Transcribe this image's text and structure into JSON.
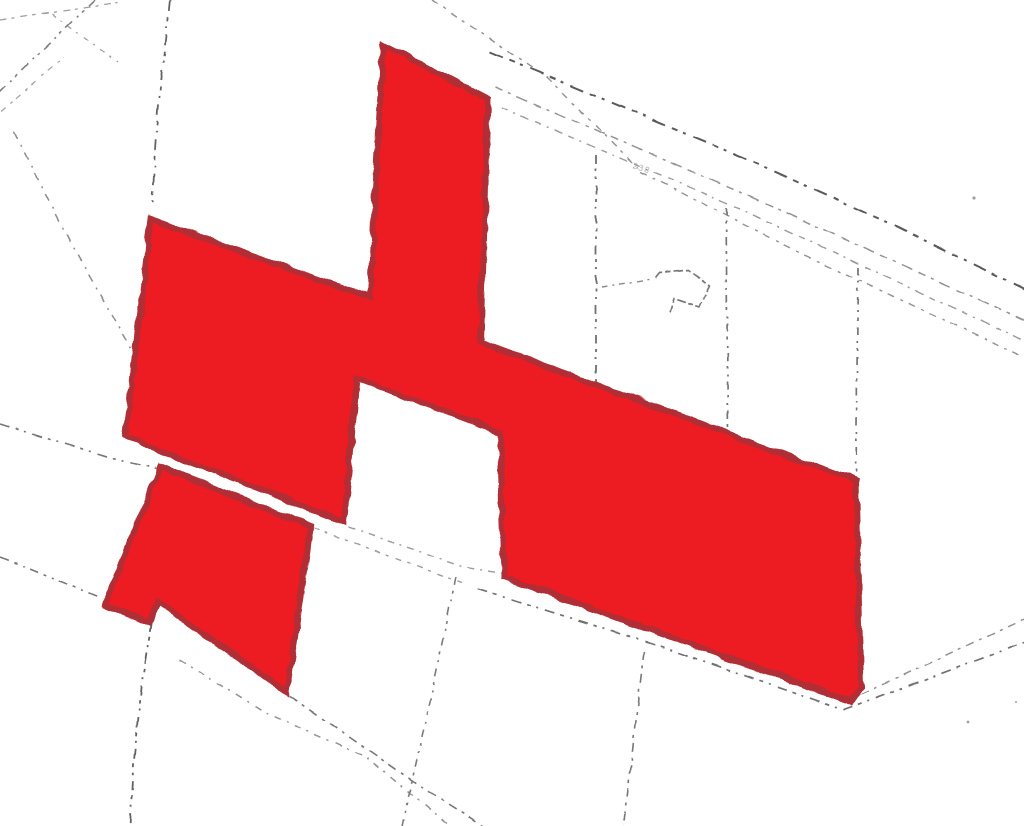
{
  "map": {
    "type": "cadastral-plan-scan",
    "background": "#ffffff",
    "highlight": {
      "fill": "#ec1c24",
      "stroke": "#b02e34",
      "stroke_width": 6
    },
    "label": {
      "text": "238",
      "size": 8,
      "color": "#979090",
      "opacity": 0.75,
      "transform": "translate(632 168) rotate(18)"
    },
    "specks": [
      {
        "x": 974,
        "y": 198,
        "r": 1.6
      },
      {
        "x": 968,
        "y": 722,
        "r": 1.4
      },
      {
        "x": 1016,
        "y": 702,
        "r": 1.0
      }
    ],
    "parcels": [
      {
        "name": "highlighted-parcel-main",
        "points": [
          [
            383,
            44
          ],
          [
            488,
            99
          ],
          [
            481,
            342
          ],
          [
            856,
            481
          ],
          [
            861,
            688
          ],
          [
            849,
            701
          ],
          [
            504,
            577
          ],
          [
            500,
            432
          ],
          [
            357,
            379
          ],
          [
            344,
            522
          ],
          [
            125,
            437
          ],
          [
            151,
            219
          ],
          [
            370,
            297
          ]
        ]
      },
      {
        "name": "highlighted-parcel-small",
        "points": [
          [
            160,
            467
          ],
          [
            311,
            526
          ],
          [
            287,
            692
          ],
          [
            158,
            602
          ],
          [
            150,
            622
          ],
          [
            105,
            604
          ]
        ]
      }
    ],
    "boundary_lines": [
      {
        "name": "tl-top-edge-line",
        "color": "#8d8d8d",
        "w": 1.3,
        "dash": "7 5 3 6",
        "points": [
          [
            0,
            20
          ],
          [
            118,
            3
          ]
        ]
      },
      {
        "name": "tl-cross-line-a",
        "color": "#909090",
        "w": 1.3,
        "dash": "5 6 2 7",
        "points": [
          [
            52,
            14
          ],
          [
            118,
            62
          ]
        ]
      },
      {
        "name": "tl-cross-line-b",
        "color": "#949494",
        "w": 1.3,
        "dash": "6 7 3 5",
        "points": [
          [
            0,
            112
          ],
          [
            64,
            57
          ]
        ]
      },
      {
        "name": "tl-diagonal-line",
        "color": "#6b6b6b",
        "w": 1.6,
        "dash": "9 6 3 5 2 6",
        "points": [
          [
            95,
            0
          ],
          [
            28,
            64
          ],
          [
            0,
            92
          ]
        ]
      },
      {
        "name": "tl-vertical-line",
        "color": "#4a4a4a",
        "w": 1.8,
        "dash": "11 6 4 5 2 7",
        "points": [
          [
            170,
            0
          ],
          [
            158,
            110
          ],
          [
            152,
            207
          ]
        ]
      },
      {
        "name": "tl-steep-line",
        "color": "#7a7a7a",
        "w": 1.5,
        "dash": "8 7 2 6",
        "points": [
          [
            14,
            132
          ],
          [
            70,
            242
          ],
          [
            133,
            352
          ]
        ]
      },
      {
        "name": "road-left-line",
        "color": "#5f5f5f",
        "w": 1.6,
        "dash": "10 6 3 6 2 7",
        "points": [
          [
            0,
            424
          ],
          [
            110,
            458
          ],
          [
            157,
            469
          ]
        ]
      },
      {
        "name": "road-tr-line-0",
        "color": "#7d7d7d",
        "w": 1.4,
        "dash": "7 6 3 7",
        "points": [
          [
            432,
            0
          ],
          [
            548,
            78
          ],
          [
            638,
            168
          ]
        ]
      },
      {
        "name": "road-tr-line-1",
        "color": "#3d3d3d",
        "w": 2.0,
        "dash": "14 7 6 6 3 8",
        "points": [
          [
            490,
            52
          ],
          [
            733,
            153
          ],
          [
            893,
            225
          ],
          [
            1024,
            289
          ]
        ]
      },
      {
        "name": "road-tr-line-2",
        "color": "#828282",
        "w": 1.5,
        "dash": "8 6 3 6 12 7",
        "points": [
          [
            495,
            87
          ],
          [
            740,
            192
          ],
          [
            1024,
            320
          ]
        ]
      },
      {
        "name": "road-tr-line-3",
        "color": "#8a8a8a",
        "w": 1.4,
        "dash": "6 6 2 6 9 7",
        "points": [
          [
            502,
            108
          ],
          [
            743,
            210
          ],
          [
            1024,
            341
          ]
        ]
      },
      {
        "name": "road-tr-line-4",
        "color": "#7f7f7f",
        "w": 1.4,
        "dash": "7 7 3 6",
        "points": [
          [
            640,
            172
          ],
          [
            800,
            253
          ],
          [
            1024,
            357
          ]
        ]
      },
      {
        "name": "boundary-vert-1",
        "color": "#565656",
        "w": 1.8,
        "dash": "9 5 3 5 2 6",
        "points": [
          [
            596,
            155
          ],
          [
            596,
            383
          ]
        ]
      },
      {
        "name": "boundary-vert-2",
        "color": "#5c5c5c",
        "w": 1.7,
        "dash": "8 5 3 6 2 5",
        "points": [
          [
            726,
            208
          ],
          [
            728,
            435
          ]
        ]
      },
      {
        "name": "boundary-vert-3",
        "color": "#5c5c5c",
        "w": 1.7,
        "dash": "8 6 2 5 3 6",
        "points": [
          [
            858,
            267
          ],
          [
            856,
            478
          ]
        ]
      },
      {
        "name": "building-lead-line",
        "color": "#757575",
        "w": 1.4,
        "dash": "6 5 2 5",
        "points": [
          [
            601,
            287
          ],
          [
            652,
            279
          ]
        ]
      },
      {
        "name": "building-outline",
        "color": "#606060",
        "w": 1.7,
        "dash": "9 3 5 3",
        "points": [
          [
            656,
            278
          ],
          [
            660,
            273
          ],
          [
            688,
            270
          ],
          [
            710,
            286
          ],
          [
            700,
            307
          ],
          [
            674,
            298
          ],
          [
            670,
            312
          ]
        ]
      },
      {
        "name": "road-mid-line-a",
        "color": "#8a8a8a",
        "w": 1.4,
        "dash": "7 6 2 6",
        "points": [
          [
            348,
            527
          ],
          [
            460,
            566
          ],
          [
            552,
            581
          ]
        ]
      },
      {
        "name": "parcel-top-ext-line",
        "color": "#8d8d8d",
        "w": 1.4,
        "dash": "6 6 3 7",
        "points": [
          [
            313,
            528
          ],
          [
            462,
            583
          ]
        ]
      },
      {
        "name": "road-mid-line-b",
        "color": "#5a5a5a",
        "w": 1.7,
        "dash": "10 6 4 6 2 7",
        "points": [
          [
            478,
            589
          ],
          [
            660,
            646
          ],
          [
            843,
            710
          ],
          [
            1024,
            643
          ]
        ]
      },
      {
        "name": "road-right-upper-line",
        "color": "#7e7e7e",
        "w": 1.5,
        "dash": "8 6 3 6",
        "points": [
          [
            862,
            694
          ],
          [
            1024,
            619
          ]
        ]
      },
      {
        "name": "road-bl-line-a",
        "color": "#606060",
        "w": 1.6,
        "dash": "9 6 3 6 2 6",
        "points": [
          [
            0,
            557
          ],
          [
            103,
            599
          ]
        ]
      },
      {
        "name": "road-bl-line-b",
        "color": "#606060",
        "w": 1.6,
        "dash": "9 6 3 6",
        "points": [
          [
            290,
            696
          ],
          [
            420,
            786
          ],
          [
            483,
            826
          ]
        ]
      },
      {
        "name": "road-bl-line-c",
        "color": "#818181",
        "w": 1.5,
        "dash": "7 6 2 7",
        "points": [
          [
            180,
            660
          ],
          [
            268,
            714
          ],
          [
            366,
            757
          ],
          [
            450,
            826
          ]
        ]
      },
      {
        "name": "boundary-vert-b1",
        "color": "#474747",
        "w": 1.8,
        "dash": "10 5 4 5 2 6",
        "points": [
          [
            152,
            622
          ],
          [
            143,
            673
          ],
          [
            133,
            770
          ],
          [
            130,
            826
          ]
        ]
      },
      {
        "name": "boundary-vert-b2",
        "color": "#636363",
        "w": 1.6,
        "dash": "8 6 3 6 2 6",
        "points": [
          [
            456,
            577
          ],
          [
            430,
            700
          ],
          [
            402,
            826
          ]
        ]
      },
      {
        "name": "boundary-vert-b3",
        "color": "#606060",
        "w": 1.6,
        "dash": "9 6 3 5",
        "points": [
          [
            644,
            651
          ],
          [
            629,
            780
          ],
          [
            624,
            826
          ]
        ]
      }
    ]
  }
}
